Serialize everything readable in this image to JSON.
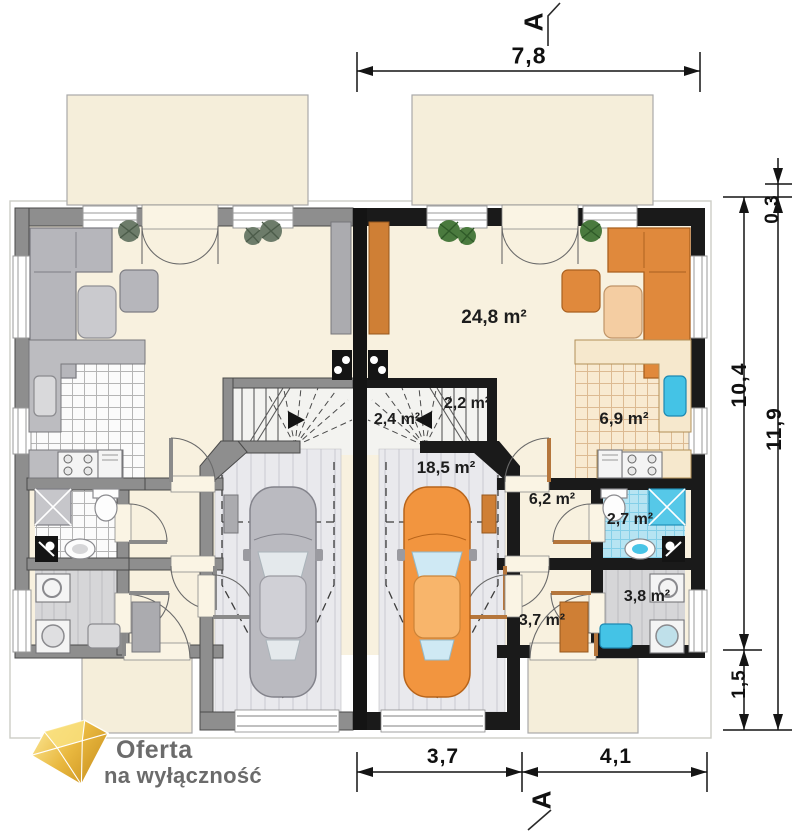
{
  "plan": {
    "section_marker_top": "A",
    "section_marker_bottom": "A",
    "rooms": {
      "living": "24,8 m²",
      "stairs_lower": "2,4 m²",
      "stairs_upper": "2,2 m²",
      "kitchen": "6,9 m²",
      "garage": "18,5 m²",
      "hall": "6,2 m²",
      "bathroom": "2,7 m²",
      "utility": "3,8 m²",
      "entry": "3,7 m²"
    },
    "dimensions": {
      "top_width": "7,8",
      "bottom_garage_width": "3,7",
      "bottom_house_width": "4,1",
      "right_roof_offset": "0,3",
      "right_house_depth": "10,4",
      "right_total_depth": "11,9",
      "right_porch_depth": "1,5"
    }
  },
  "logo": {
    "line1": "Oferta",
    "line2": "na wyłączność"
  },
  "colors": {
    "accent_orange": "#e0893c",
    "car_orange": "#f2953f",
    "bathroom_blue": "#b7e4f2",
    "fixture_blue": "#44c3e6",
    "floor_cream": "#f8f1df",
    "terrace_beige": "#f5eeda",
    "left_wall_gray": "#8e8e8e",
    "right_wall_black": "#1a1a1a",
    "logo_gold": "#e9b83f",
    "logo_text_gray": "#6b6b6b"
  }
}
